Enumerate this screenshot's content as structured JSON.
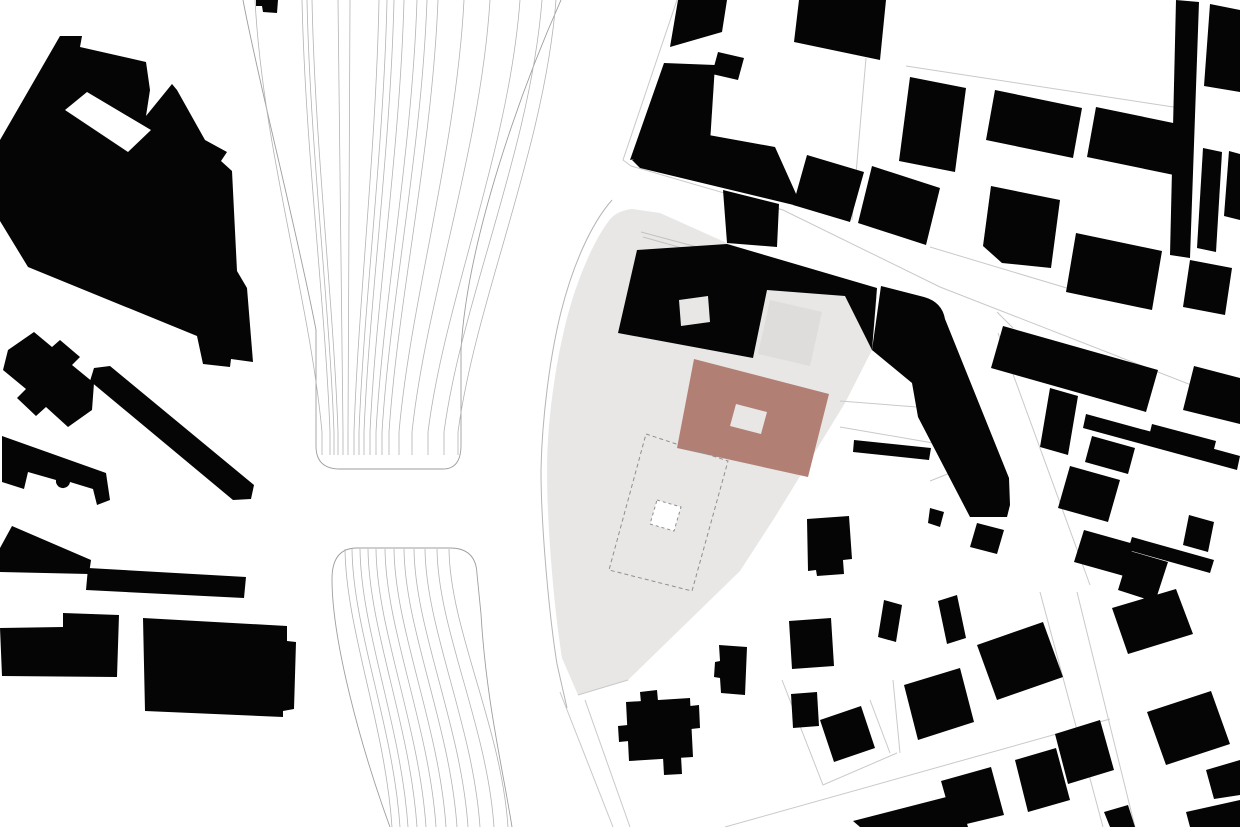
{
  "canvas": {
    "width": 1240,
    "height": 827
  },
  "colors": {
    "background": "#ffffff",
    "building": "#050505",
    "accent_building": "#b27f75",
    "site_area": "#e8e7e5",
    "site_inner_court": "#dedddb",
    "track_line": "#b3b3b3",
    "track_outline": "#9e9e9e",
    "parcel_line": "#c9c9c9",
    "faint_site_line": "#c2c2c2",
    "dashed_line": "#8f8f8f",
    "site_outline": "#b5b5b5"
  },
  "map": {
    "site": {
      "area": "M608,222 Q615,211 632,209 L660,213 L727,243 L858,288 L877,297 L872,350 L845,403 L775,517 L740,571 L628,680 L578,695 L562,658 C554,608 547,525 547,470 C547,420 556,362 566,322 C576,282 592,244 608,222 Z",
      "outline": "M612,200 C590,225 572,268 561,312 C550,356 542,418 541,470 C541,526 549,614 557,664 L567,708",
      "inner_court": "M770,300 L822,312 L810,366 L758,354 Z",
      "surface_lines": [
        "M641,232 L712,251",
        "M643,237 L700,253"
      ]
    },
    "tracks": {
      "upper_outline": "M243,0 C258,80 299,240 316,330 L316,446 Q316,469 340,469 L443,469 Q461,469 461,445 L461,350 C467,240 521,90 561,0",
      "lower_outline": "M390,827 C360,745 332,640 332,579 Q332,548 357,548 L450,548 Q476,548 477,574 L481,614 C486,700 503,770 512,827",
      "upper_lines": [
        [
          255,
          322
        ],
        [
          302,
          330
        ],
        [
          307,
          334
        ],
        [
          312,
          338
        ],
        [
          338,
          343
        ],
        [
          350,
          348
        ],
        [
          379,
          354
        ],
        [
          387,
          359
        ],
        [
          394,
          364
        ],
        [
          404,
          370
        ],
        [
          417,
          376
        ],
        [
          427,
          382
        ],
        [
          438,
          389
        ],
        [
          464,
          399
        ],
        [
          490,
          412
        ],
        [
          520,
          428
        ],
        [
          542,
          444
        ],
        [
          556,
          458
        ]
      ],
      "lower_lines": [
        [
          345,
          392
        ],
        [
          352,
          400
        ],
        [
          360,
          408
        ],
        [
          368,
          417
        ],
        [
          376,
          426
        ],
        [
          385,
          436
        ],
        [
          394,
          446
        ],
        [
          404,
          457
        ],
        [
          414,
          468
        ],
        [
          425,
          480
        ],
        [
          437,
          494
        ],
        [
          449,
          508
        ]
      ]
    },
    "parcel_lines": [
      "M677,0 L623,160 L631,166 L783,210 L940,287 L1240,404",
      "M866,58 L852,220",
      "M906,66 L1180,108",
      "M930,247 L1100,298",
      "M998,333 L1090,585",
      "M1040,592 L1103,827",
      "M1077,592 L1135,827",
      "M560,692 L613,827",
      "M585,700 L630,827",
      "M782,680 L823,785 L897,753",
      "M870,700 L890,753",
      "M893,680 L900,753",
      "M725,827 L1110,719",
      "M872,350 L917,340",
      "M840,401 L917,407",
      "M840,427 L933,443",
      "M997,312 L1013,328",
      "M930,481 L970,465",
      "M578,695 L628,680"
    ],
    "buildings": [
      "M60,36 L82,36 L80,47 L146,62 L150,90 L146,116 L172,84 L177,90 L205,140 L227,152 L221,161 L232,171 L237,271 L247,288 L253,362 L231,359 L230,367 L203,364 L197,336 L28,267 L0,221 L0,140 Z",
      "M8,350 L34,332 L52,347 L60,340 L80,357 L72,365 L94,383 L92,410 L68,427 L46,407 L36,416 L17,398 L26,389 L3,370 Z",
      "M94,368 L110,366 L254,485 L251,499 L233,500 L90,381 Z",
      "M2,436 L106,473 L110,500 L97,505 L93,489 L70,482 A7,7 0 0 1 56,480 L28,472 L24,489 L2,482 Z",
      "M12,526 L91,560 L89,574 L0,572 L0,548 Z",
      "M88,568 L246,577 L244,598 L86,590 Z",
      "M0,628 L63,627 L63,613 L119,615 L117,677 L2,676 Z",
      "M143,618 L287,626 L287,641 L296,642 L294,709 L283,711 L283,717 L145,711 Z",
      "M256,0 L278,0 L277,13 L263,12 L262,6 L256,6 Z",
      "M637,250 L727,244 L877,288 L872,350 L845,296 L767,290 L753,358 L618,333 Z M679,300 L708,296 L710,322 L681,326 Z",
      "M678,0 L727,0 L722,32 L670,47 Z",
      "M718,52 L744,58 L738,80 L712,74 Z",
      "M664,63 L715,65 L710,143 L630,160 Z",
      "M632,160 L692,132 L775,147 L797,196 L802,207 L640,168 Z",
      "M723,190 L779,204 L777,247 L727,243 Z",
      "M799,0 L886,0 L880,60 L794,42 Z",
      "M807,155 L864,172 L850,222 L793,205 Z",
      "M872,166 L940,188 L926,245 L858,223 Z",
      "M910,77 L966,88 L955,172 L899,161 Z",
      "M995,90 L1082,108 L1073,158 L986,140 Z",
      "M1096,107 L1183,125 L1174,175 L1087,157 Z",
      "M1176,0 L1199,2 L1190,258 L1170,255 Z",
      "M1210,4 L1240,10 L1240,92 L1204,86 Z",
      "M991,186 L1060,200 L1051,268 L1002,263 L983,246 Z",
      "M1076,233 L1162,251 L1152,310 L1066,292 Z",
      "M1203,148 L1222,152 L1216,252 L1197,248 Z",
      "M1229,151 L1240,154 L1240,220 L1224,216 Z",
      "M1190,260 L1232,268 L1225,315 L1183,307 Z",
      "M881,286 L924,297 Q942,302 945,319 L1009,478 L1010,505 L1007,517 L970,517 L918,417 L912,383 L872,350 Z",
      "M854,440 L931,448 L929,460 L853,452 Z",
      "M1003,326 L1158,370 L1146,412 L991,368 Z",
      "M1194,366 L1240,378 L1240,424 L1183,410 Z",
      "M1086,414 L1240,456 L1237,470 L1083,428 Z",
      "M1152,424 L1216,441 L1211,461 L1147,444 Z",
      "M1050,388 L1078,396 L1068,455 L1040,447 Z",
      "M1092,436 L1135,448 L1128,474 L1085,462 Z",
      "M1070,466 L1120,480 L1108,522 L1058,508 Z",
      "M1084,530 L1134,544 L1124,576 L1074,562 Z",
      "M1132,537 L1214,560 L1210,573 L1128,550 Z",
      "M1189,515 L1214,522 L1208,552 L1183,545 Z",
      "M1130,551 L1168,562 L1155,602 L1118,590 Z",
      "M977,523 L1004,530 L997,554 L970,547 Z",
      "M930,508 L944,512 L940,527 L928,523 Z",
      "M977,645 L1043,622 L1063,677 L997,700 Z",
      "M1112,608 L1176,589 L1193,634 L1128,654 Z",
      "M1147,712 L1211,691 L1230,744 L1166,765 Z",
      "M1206,770 L1240,760 L1240,795 L1214,799 Z",
      "M1186,812 L1240,800 L1240,827 L1190,827 Z",
      "M1104,812 L1128,805 L1135,827 L1110,827 Z",
      "M853,821 L958,794 L968,827 L860,827 Z",
      "M941,781 L991,767 L1004,815 L954,827 Z",
      "M1015,760 L1056,748 L1070,800 L1028,812 Z",
      "M1055,734 L1100,720 L1114,770 L1068,784 Z",
      "M904,685 L960,668 L974,722 L918,740 Z",
      "M938,601 L957,595 L966,638 L947,644 Z",
      "M884,600 L902,605 L896,642 L878,637 Z",
      "M626,702 L690,698 L693,757 L629,761 Z",
      "M640,692 L657,690 L658,701 L641,703 Z",
      "M690,706 L699,705 L700,728 L691,729 Z",
      "M663,757 L681,756 L682,774 L664,775 Z",
      "M618,726 L628,725 L629,741 L619,742 Z",
      "M719,645 L747,647 L745,695 L721,693 L720,678 L714,677 L715,662 L720,661 Z",
      "M791,694 L817,692 L819,726 L793,728 Z",
      "M820,720 L861,706 L875,748 L834,762 Z",
      "M789,621 L831,618 L834,666 L792,669 Z",
      "M807,519 L849,516 L852,559 L843,560 L844,574 L817,576 L816,570 L808,571 Z"
    ],
    "white_cutouts": [
      "M65,110 L87,92 L151,130 L128,152 Z"
    ],
    "proposed_building": "M694,359 L829,394 L808,477 L677,448 Z M736,404 L767,412 L761,434 L730,426 Z",
    "dashed_plot": "M646,434 L728,461 L692,591 L609,570 Z",
    "dashed_inner_building": "M657,500 L681,507 L674,531 L650,524 Z"
  }
}
